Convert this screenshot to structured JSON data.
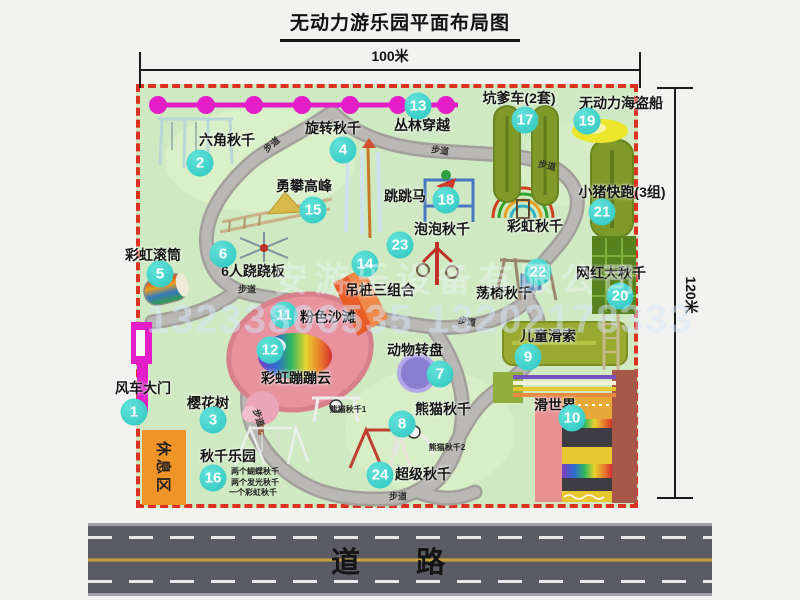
{
  "title": "无动力游乐园平面布局图",
  "dimensions": {
    "width_label": "100米",
    "height_label": "120米"
  },
  "road": {
    "label": "道 路"
  },
  "rest_area": {
    "label": "休息区"
  },
  "watermark": {
    "company": "安游乐设备有限公司",
    "phones": "13233806535 13202178333"
  },
  "colors": {
    "map_green": "#cfe9c2",
    "border_red": "#dc3020",
    "badge_cyan": "#2cc6bf",
    "chain_magenta": "#e31ec8",
    "path_gray": "#b4b2ae",
    "road_gray": "#5b5b63",
    "rest_area_orange": "#f09428",
    "beach_pink": "#e8929e"
  },
  "attractions": [
    {
      "num": "1",
      "name": "风车大门",
      "badge": [
        134,
        412
      ],
      "label": [
        143,
        388
      ]
    },
    {
      "num": "2",
      "name": "六角秋千",
      "badge": [
        200,
        163
      ],
      "label": [
        227,
        140
      ]
    },
    {
      "num": "3",
      "name": "樱花树",
      "badge": [
        213,
        420
      ],
      "label": [
        208,
        403
      ]
    },
    {
      "num": "4",
      "name": "旋转秋千",
      "badge": [
        343,
        150
      ],
      "label": [
        333,
        128
      ]
    },
    {
      "num": "5",
      "name": "彩虹滚筒",
      "badge": [
        160,
        274
      ],
      "label": [
        153,
        255
      ]
    },
    {
      "num": "6",
      "name": "6人跷跷板",
      "badge": [
        223,
        254
      ],
      "label": [
        253,
        271
      ]
    },
    {
      "num": "7",
      "name": "动物转盘",
      "badge": [
        440,
        374
      ],
      "label": [
        415,
        350
      ]
    },
    {
      "num": "8",
      "name": "熊猫秋千",
      "badge": [
        402,
        424
      ],
      "label": [
        443,
        409
      ]
    },
    {
      "num": "9",
      "name": "儿童滑索",
      "badge": [
        528,
        357
      ],
      "label": [
        548,
        336
      ]
    },
    {
      "num": "10",
      "name": "滑世界",
      "badge": [
        572,
        418
      ],
      "label": [
        555,
        405
      ]
    },
    {
      "num": "11",
      "name": "粉色沙滩",
      "badge": [
        284,
        315
      ],
      "label": [
        328,
        317
      ]
    },
    {
      "num": "12",
      "name": "彩虹蹦蹦云",
      "badge": [
        270,
        350
      ],
      "label": [
        296,
        378
      ]
    },
    {
      "num": "13",
      "name": "丛林穿越",
      "badge": [
        418,
        106
      ],
      "label": [
        422,
        125
      ]
    },
    {
      "num": "14",
      "name": "吊桩三组合",
      "badge": [
        365,
        264
      ],
      "label": [
        380,
        290
      ]
    },
    {
      "num": "15",
      "name": "勇攀高峰",
      "badge": [
        313,
        210
      ],
      "label": [
        304,
        186
      ]
    },
    {
      "num": "16",
      "name": "秋千乐园",
      "badge": [
        213,
        478
      ],
      "label": [
        228,
        456
      ]
    },
    {
      "num": "17",
      "name": "坑爹车(2套)",
      "badge": [
        525,
        120
      ],
      "label": [
        519,
        98
      ]
    },
    {
      "num": "18",
      "name": "跳跳马",
      "badge": [
        446,
        200
      ],
      "label": [
        405,
        196
      ]
    },
    {
      "num": "19",
      "name": "无动力海盗船",
      "badge": [
        587,
        121
      ],
      "label": [
        621,
        103
      ]
    },
    {
      "num": "20",
      "name": "网红大秋千",
      "badge": [
        620,
        296
      ],
      "label": [
        611,
        273
      ]
    },
    {
      "num": "21",
      "name": "小猪快跑(3组)",
      "badge": [
        602,
        212
      ],
      "label": [
        622,
        192
      ]
    },
    {
      "num": "22",
      "name": "荡椅秋千",
      "badge": [
        538,
        272
      ],
      "label": [
        504,
        293
      ]
    },
    {
      "num": "23",
      "name": "泡泡秋千",
      "badge": [
        400,
        245
      ],
      "label": [
        442,
        229
      ]
    },
    {
      "num": "24",
      "name": "超级秋千",
      "badge": [
        380,
        475
      ],
      "label": [
        423,
        474
      ]
    },
    {
      "num": null,
      "name": "彩虹秋千",
      "badge": null,
      "label": [
        535,
        226
      ]
    }
  ],
  "sub_labels": [
    {
      "text": "熊猫秋千1",
      "x": 348,
      "y": 410
    },
    {
      "text": "熊猫秋千2",
      "x": 447,
      "y": 448
    },
    {
      "text": "两个蝴蝶秋千",
      "x": 255,
      "y": 472
    },
    {
      "text": "两个发光秋千",
      "x": 255,
      "y": 483
    },
    {
      "text": "一个彩虹秋千",
      "x": 253,
      "y": 493
    }
  ],
  "path_labels": [
    {
      "text": "步道",
      "x": 272,
      "y": 145,
      "rot": -40
    },
    {
      "text": "步道",
      "x": 440,
      "y": 151,
      "rot": 8
    },
    {
      "text": "步道",
      "x": 547,
      "y": 166,
      "rot": 12
    },
    {
      "text": "步道",
      "x": 247,
      "y": 290,
      "rot": 0
    },
    {
      "text": "步道",
      "x": 467,
      "y": 322,
      "rot": 10
    },
    {
      "text": "步道",
      "x": 258,
      "y": 418,
      "rot": 72
    },
    {
      "text": "步道",
      "x": 398,
      "y": 497,
      "rot": 0
    }
  ]
}
